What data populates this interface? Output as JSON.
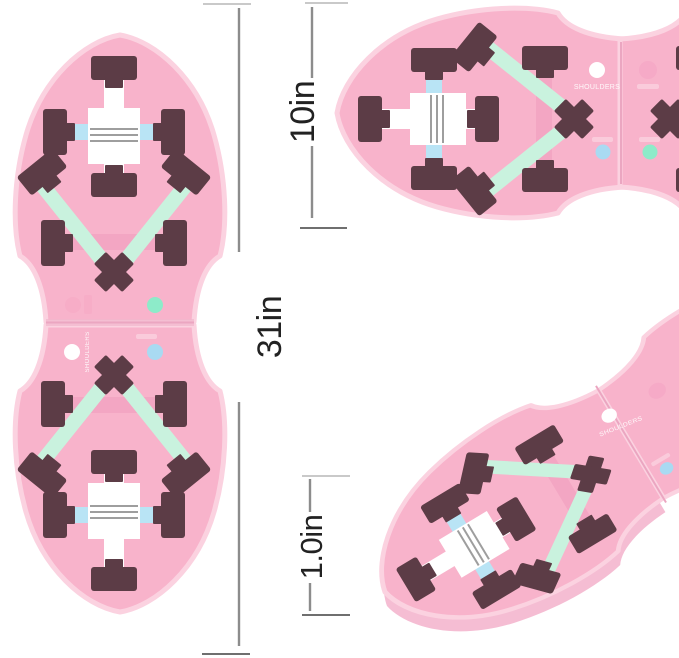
{
  "product": {
    "description": "Pink foldable push-up board shown in three views with dimension callouts"
  },
  "dimensions": {
    "height_label": "31in",
    "width_label": "10in",
    "thickness_label": "1.0in"
  },
  "board": {
    "shoulders_label": "SHOULDERS"
  },
  "colors": {
    "background": "#ffffff",
    "board_pink": "#f8b3cb",
    "board_rim": "#fbd2e0",
    "board_edge": "#f5bdd3",
    "peg_dark": "#5c3c46",
    "strap_blue": "#b9e4f5",
    "strap_mint": "#c9f2de",
    "strap_pink": "#f3a6c3",
    "buckle_white": "#ffffff",
    "stripe_gray": "#9e9e9e",
    "seam_pink": "#eba6c1",
    "dot_white": "#ffffff",
    "dot_blue": "#a9daf2",
    "dot_mint": "#8debc9",
    "dot_pink": "#f5a8c5",
    "dim_line": "#8c8c8c",
    "dim_tick_light": "#c9c9c9",
    "dim_tick_dark": "#6f6f6f",
    "dim_text": "#222222"
  }
}
